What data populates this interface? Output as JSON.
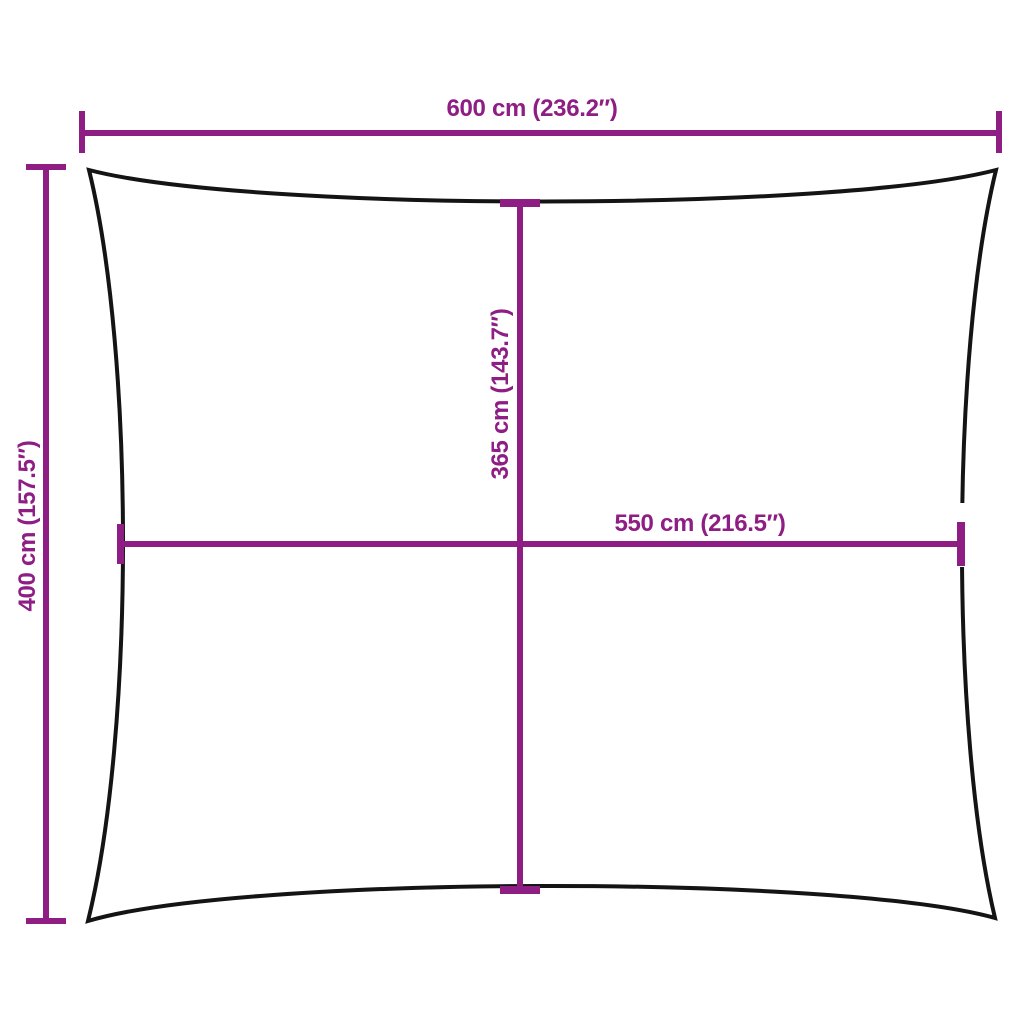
{
  "diagram": {
    "dimension_labels": {
      "top_width": "600 cm (236.2″)",
      "left_height": "400 cm (157.5″)",
      "middle_height": "365 cm (143.7″)",
      "middle_width": "550 cm (216.5″)"
    },
    "colors": {
      "dimension": "#8E1D84",
      "outline": "#141414",
      "background": "#FFFFFF"
    }
  }
}
